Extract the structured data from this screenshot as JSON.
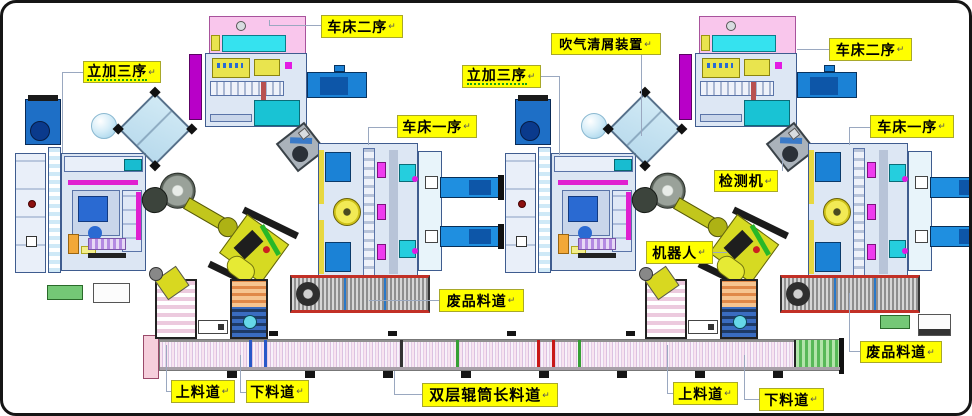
{
  "canvas": {
    "width": 972,
    "height": 416,
    "background": "#ffffff",
    "border_color": "#151515"
  },
  "palette": {
    "label_bg": "#ffff00",
    "label_border": "#a8a82a",
    "label_text": "#000000",
    "connector": "#9aa8c0",
    "machine_blue": "#1b82d6",
    "machine_panel": "#dde7f4",
    "magenta": "#b800c8",
    "teal": "#19c3d4",
    "pink": "#f9c6ec",
    "robot_yellow": "#d6da22",
    "conveyor_red_edge": "#c23026",
    "scrap_green": "#58b858"
  },
  "marks": {
    "return": "↵"
  },
  "callouts": [
    {
      "id": "vmc-left",
      "text": "立加三序",
      "underline": true
    },
    {
      "id": "lathe2-left",
      "text": "车床二序"
    },
    {
      "id": "lathe1-left",
      "text": "车床一序"
    },
    {
      "id": "air-blow",
      "text": "吹气清屑装置"
    },
    {
      "id": "vmc-right",
      "text": "立加三序",
      "underline": true
    },
    {
      "id": "lathe2-right",
      "text": "车床二序"
    },
    {
      "id": "lathe1-right",
      "text": "车床一序"
    },
    {
      "id": "detector",
      "text": "检测机"
    },
    {
      "id": "robot",
      "text": "机器人"
    },
    {
      "id": "scrap-middle",
      "text": "废品料道"
    },
    {
      "id": "scrap-right",
      "text": "废品料道"
    },
    {
      "id": "load-left",
      "text": "上料道"
    },
    {
      "id": "unload-left",
      "text": "下料道"
    },
    {
      "id": "long-conveyor",
      "text": "双层辊筒长料道"
    },
    {
      "id": "load-right",
      "text": "上料道"
    },
    {
      "id": "unload-right",
      "text": "下料道"
    }
  ]
}
